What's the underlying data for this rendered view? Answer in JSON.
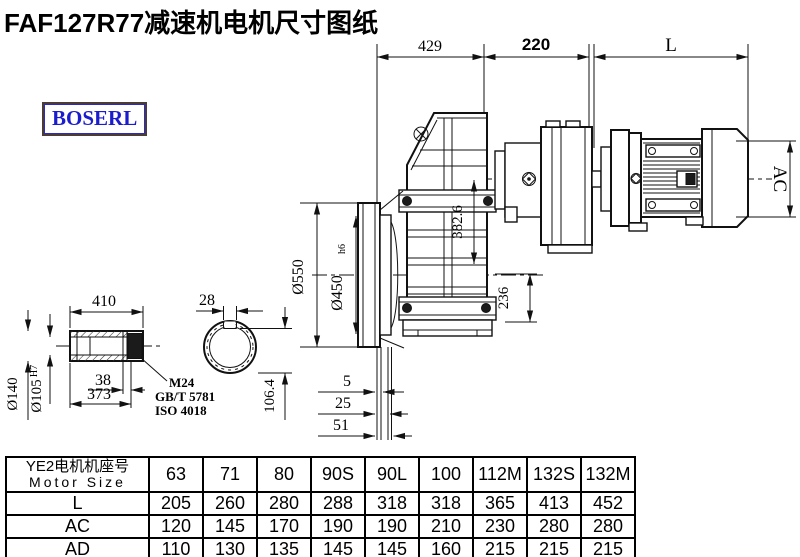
{
  "title": "FAF127R77减速机电机尺寸图纸",
  "logo": {
    "text": "BOSERL"
  },
  "colors": {
    "line": "#111111",
    "logo_text": "#1c1ccf",
    "logo_border": "#4d3b35"
  },
  "drawing": {
    "dims": {
      "d429": "429",
      "d220": "220",
      "dL": "L",
      "dAC": "AC",
      "d382": "382.6",
      "d236": "236",
      "d550": "Ø550",
      "d450": "Ø450",
      "d450_tol": "h6",
      "d5": "5",
      "d25": "25",
      "d51": "51",
      "d410": "410",
      "d28": "28",
      "d140": "Ø140",
      "d105": "Ø105",
      "d105_tol": "H7",
      "d38": "38",
      "d373": "373",
      "d106": "106.4",
      "m24": "M24",
      "gbt": "GB/T 5781",
      "iso": "ISO 4018"
    }
  },
  "table": {
    "header": {
      "motor_cn": "YE2电机机座号",
      "motor_en": "Motor Size",
      "sizes": [
        "63",
        "71",
        "80",
        "90S",
        "90L",
        "100",
        "112M",
        "132S",
        "132M"
      ]
    },
    "rows": [
      {
        "label": "L",
        "values": [
          "205",
          "260",
          "280",
          "288",
          "318",
          "318",
          "365",
          "413",
          "452"
        ]
      },
      {
        "label": "AC",
        "values": [
          "120",
          "145",
          "170",
          "190",
          "190",
          "210",
          "230",
          "280",
          "280"
        ]
      },
      {
        "label": "AD",
        "values": [
          "110",
          "130",
          "135",
          "145",
          "145",
          "160",
          "215",
          "215",
          "215"
        ]
      }
    ]
  }
}
